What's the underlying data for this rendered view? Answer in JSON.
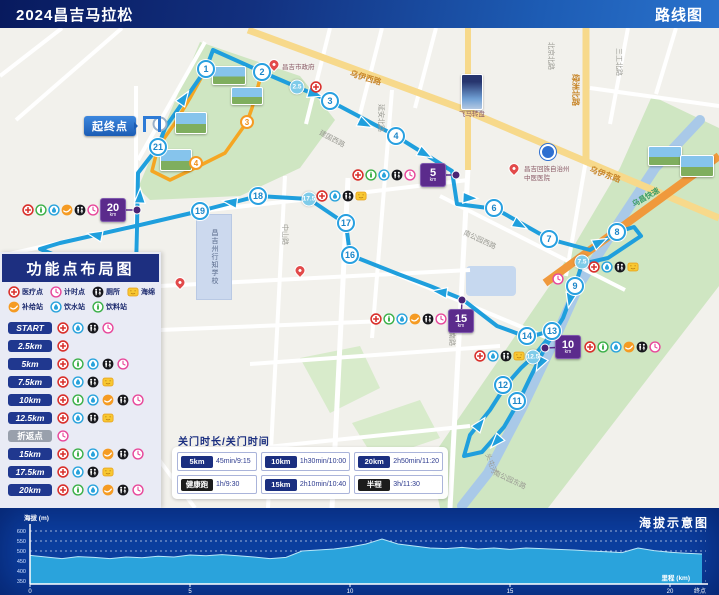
{
  "header": {
    "title": "2024昌吉马拉松",
    "subtitle": "路线图"
  },
  "colors": {
    "route": "#1f9fdd",
    "orange_route": "#f5a623",
    "km_box": "#5b2b8c",
    "park": "#cfe6c2",
    "river": "#a9c9e8",
    "road_yellow": "#f7d98b",
    "expressway": "#f0993c",
    "footer_bg": "#0c3fa0",
    "area_fill": "#2aa3dc"
  },
  "panel": {
    "title": "功能点布局图",
    "key_line1": [
      {
        "icon": "medical",
        "label": "医疗点"
      },
      {
        "icon": "clock",
        "label": "计时点"
      },
      {
        "icon": "toilet",
        "label": "厕所"
      },
      {
        "icon": "sponge",
        "label": "海绵"
      }
    ],
    "key_line2": [
      {
        "icon": "supply",
        "label": "补给站"
      },
      {
        "icon": "water",
        "label": "饮水站"
      },
      {
        "icon": "drink",
        "label": "饮料站"
      }
    ],
    "rows": [
      {
        "label": "START",
        "style": "blue",
        "icons": [
          "medical",
          "water",
          "toilet",
          "clock"
        ]
      },
      {
        "label": "2.5km",
        "style": "blue",
        "icons": [
          "medical"
        ]
      },
      {
        "label": "5km",
        "style": "blue",
        "icons": [
          "medical",
          "drink",
          "water",
          "toilet",
          "clock"
        ]
      },
      {
        "label": "7.5km",
        "style": "blue",
        "icons": [
          "medical",
          "water",
          "toilet",
          "sponge"
        ]
      },
      {
        "label": "10km",
        "style": "blue",
        "icons": [
          "medical",
          "drink",
          "water",
          "supply",
          "toilet",
          "clock"
        ]
      },
      {
        "label": "12.5km",
        "style": "blue",
        "icons": [
          "medical",
          "water",
          "toilet",
          "sponge"
        ]
      },
      {
        "label": "折返点",
        "style": "gray",
        "icons": [
          "clock"
        ]
      },
      {
        "label": "15km",
        "style": "blue",
        "icons": [
          "medical",
          "drink",
          "water",
          "supply",
          "toilet",
          "clock"
        ]
      },
      {
        "label": "17.5km",
        "style": "blue",
        "icons": [
          "medical",
          "water",
          "toilet",
          "sponge"
        ]
      },
      {
        "label": "20km",
        "style": "blue",
        "icons": [
          "medical",
          "drink",
          "water",
          "supply",
          "toilet",
          "clock"
        ]
      }
    ]
  },
  "map": {
    "start_callout": "起终点",
    "km_markers": [
      {
        "n": "1",
        "x": 206,
        "y": 41,
        "kind": "km"
      },
      {
        "n": "2",
        "x": 262,
        "y": 44,
        "kind": "km"
      },
      {
        "n": "2.5",
        "x": 297,
        "y": 59,
        "kind": "half"
      },
      {
        "n": "3",
        "x": 330,
        "y": 73,
        "kind": "km"
      },
      {
        "n": "4",
        "x": 396,
        "y": 108,
        "kind": "km"
      },
      {
        "n": "6",
        "x": 494,
        "y": 180,
        "kind": "km"
      },
      {
        "n": "7",
        "x": 549,
        "y": 211,
        "kind": "km"
      },
      {
        "n": "8",
        "x": 617,
        "y": 204,
        "kind": "km"
      },
      {
        "n": "7.5",
        "x": 582,
        "y": 234,
        "kind": "half"
      },
      {
        "n": "9",
        "x": 575,
        "y": 258,
        "kind": "km"
      },
      {
        "n": "11",
        "x": 517,
        "y": 373,
        "kind": "km"
      },
      {
        "n": "12",
        "x": 503,
        "y": 357,
        "kind": "km"
      },
      {
        "n": "12.5",
        "x": 533,
        "y": 329,
        "kind": "half"
      },
      {
        "n": "13",
        "x": 552,
        "y": 303,
        "kind": "km"
      },
      {
        "n": "14",
        "x": 527,
        "y": 308,
        "kind": "km"
      },
      {
        "n": "16",
        "x": 350,
        "y": 227,
        "kind": "km"
      },
      {
        "n": "17",
        "x": 346,
        "y": 195,
        "kind": "km"
      },
      {
        "n": "17.5",
        "x": 309,
        "y": 171,
        "kind": "half"
      },
      {
        "n": "18",
        "x": 258,
        "y": 168,
        "kind": "km"
      },
      {
        "n": "19",
        "x": 200,
        "y": 183,
        "kind": "km"
      },
      {
        "n": "21",
        "x": 158,
        "y": 119,
        "kind": "km"
      },
      {
        "n": "3",
        "x": 247,
        "y": 94,
        "kind": "orange"
      },
      {
        "n": "4",
        "x": 196,
        "y": 135,
        "kind": "orange"
      }
    ],
    "km_boxes": [
      {
        "n": "5",
        "unit": "km",
        "x": 433,
        "y": 147,
        "dx": 456,
        "dy": 147
      },
      {
        "n": "10",
        "unit": "km",
        "x": 568,
        "y": 319,
        "dx": 545,
        "dy": 320
      },
      {
        "n": "15",
        "unit": "km",
        "x": 461,
        "y": 293,
        "dx": 462,
        "dy": 272
      },
      {
        "n": "20",
        "unit": "km",
        "x": 113,
        "y": 182,
        "dx": 137,
        "dy": 182
      }
    ],
    "clusters": [
      {
        "x": 352,
        "y": 141,
        "icons": [
          "medical",
          "drink",
          "water",
          "toilet",
          "clock"
        ]
      },
      {
        "x": 588,
        "y": 233,
        "icons": [
          "medical",
          "water",
          "toilet",
          "sponge"
        ]
      },
      {
        "x": 584,
        "y": 313,
        "icons": [
          "medical",
          "drink",
          "water",
          "supply",
          "toilet",
          "clock"
        ]
      },
      {
        "x": 474,
        "y": 322,
        "icons": [
          "medical",
          "water",
          "toilet",
          "sponge"
        ]
      },
      {
        "x": 370,
        "y": 285,
        "icons": [
          "medical",
          "drink",
          "water",
          "supply",
          "toilet",
          "clock"
        ]
      },
      {
        "x": 316,
        "y": 162,
        "icons": [
          "medical",
          "water",
          "toilet",
          "sponge"
        ]
      },
      {
        "x": 22,
        "y": 176,
        "icons": [
          "medical",
          "drink",
          "water",
          "supply",
          "toilet",
          "clock"
        ]
      },
      {
        "x": 310,
        "y": 53,
        "icons": [
          "medical"
        ]
      },
      {
        "x": 552,
        "y": 245,
        "icons": [
          "clock"
        ]
      }
    ],
    "road_labels": [
      {
        "t": "乌伊西路",
        "x": 352,
        "y": 40,
        "r": 17,
        "c": "y"
      },
      {
        "t": "乌伊东路",
        "x": 592,
        "y": 136,
        "r": 20,
        "c": "y"
      },
      {
        "t": "绿洲北路",
        "x": 581,
        "y": 46,
        "r": 90,
        "c": "y"
      },
      {
        "t": "北京北路",
        "x": 556,
        "y": 14,
        "r": 90,
        "c": ""
      },
      {
        "t": "延安北路",
        "x": 386,
        "y": 76,
        "r": 90,
        "c": ""
      },
      {
        "t": "建国西路",
        "x": 322,
        "y": 100,
        "r": 28,
        "c": ""
      },
      {
        "t": "中山路",
        "x": 290,
        "y": 196,
        "r": 90,
        "c": ""
      },
      {
        "t": "北京南路",
        "x": 457,
        "y": 290,
        "r": 90,
        "c": ""
      },
      {
        "t": "三工北路",
        "x": 624,
        "y": 20,
        "r": 90,
        "c": ""
      },
      {
        "t": "南公园西路",
        "x": 466,
        "y": 200,
        "r": 25,
        "c": ""
      },
      {
        "t": "南公园东路",
        "x": 496,
        "y": 440,
        "r": 25,
        "c": ""
      },
      {
        "t": "宁边西路",
        "x": 38,
        "y": 284,
        "r": -40,
        "c": ""
      },
      {
        "t": "头屯河",
        "x": 492,
        "y": 424,
        "r": 70,
        "c": ""
      },
      {
        "t": "乌昌快速",
        "x": 630,
        "y": 172,
        "r": -30,
        "c": "grn"
      }
    ],
    "pois": [
      {
        "type": "pin",
        "x": 274,
        "y": 42
      },
      {
        "type": "label",
        "text": "昌吉市政府",
        "x": 282,
        "y": 36
      },
      {
        "type": "pin",
        "x": 514,
        "y": 146
      },
      {
        "type": "label",
        "text": "昌吉回族自治州",
        "x": 524,
        "y": 138
      },
      {
        "type": "label",
        "text": "中医医院",
        "x": 524,
        "y": 147
      },
      {
        "type": "label",
        "text": "飞马转盘",
        "x": 459,
        "y": 83
      },
      {
        "type": "pin",
        "x": 180,
        "y": 260
      },
      {
        "type": "pin",
        "x": 300,
        "y": 248
      }
    ],
    "school_block": {
      "text": "昌吉州行知学校",
      "x": 196,
      "y": 186,
      "w": 34,
      "h": 84
    },
    "photos": [
      {
        "x": 212,
        "y": 38,
        "w": 32,
        "h": 17,
        "kind": "scene"
      },
      {
        "x": 231,
        "y": 59,
        "w": 30,
        "h": 16,
        "kind": "scene"
      },
      {
        "x": 175,
        "y": 84,
        "w": 30,
        "h": 20,
        "kind": "scene"
      },
      {
        "x": 160,
        "y": 121,
        "w": 30,
        "h": 20,
        "kind": "scene"
      },
      {
        "x": 461,
        "y": 46,
        "w": 20,
        "h": 34,
        "kind": "tower"
      },
      {
        "x": 648,
        "y": 118,
        "w": 32,
        "h": 18,
        "kind": "scene"
      },
      {
        "x": 680,
        "y": 127,
        "w": 32,
        "h": 20,
        "kind": "scene"
      }
    ],
    "roundabout_icon": {
      "x": 548,
      "y": 124
    }
  },
  "table": {
    "title": "关门时长/关门时间",
    "rows": [
      [
        {
          "label": "5km",
          "style": "blue",
          "value": "45min/9:15"
        },
        {
          "label": "10km",
          "style": "blue",
          "value": "1h30min/10:00"
        },
        {
          "label": "20km",
          "style": "blue",
          "value": "2h50min/11:20"
        }
      ],
      [
        {
          "label": "健康跑",
          "style": "black",
          "value": "1h/9:30"
        },
        {
          "label": "15km",
          "style": "blue",
          "value": "2h10min/10:40"
        },
        {
          "label": "半程",
          "style": "black",
          "value": "3h/11:30"
        }
      ]
    ]
  },
  "chart_data": {
    "type": "area",
    "title": "海拔示意图",
    "ylabel": "海拔 (m)",
    "xlabel": "里程 (km)",
    "end_label": "终点",
    "x_start_km": 0,
    "x_step_km": 0.5,
    "x_ticks": [
      0,
      5,
      10,
      15,
      20
    ],
    "y_ticks": [
      600,
      550,
      500,
      450,
      400,
      350
    ],
    "ylim": [
      335,
      615
    ],
    "xlim": [
      0,
      21
    ],
    "grid": true,
    "values": [
      478,
      470,
      462,
      472,
      468,
      462,
      470,
      466,
      474,
      470,
      480,
      476,
      482,
      476,
      470,
      462,
      468,
      500,
      505,
      510,
      520,
      535,
      560,
      535,
      525,
      515,
      512,
      518,
      510,
      515,
      508,
      515,
      512,
      508,
      505,
      500,
      496,
      492,
      515,
      502,
      494,
      489,
      485
    ]
  }
}
